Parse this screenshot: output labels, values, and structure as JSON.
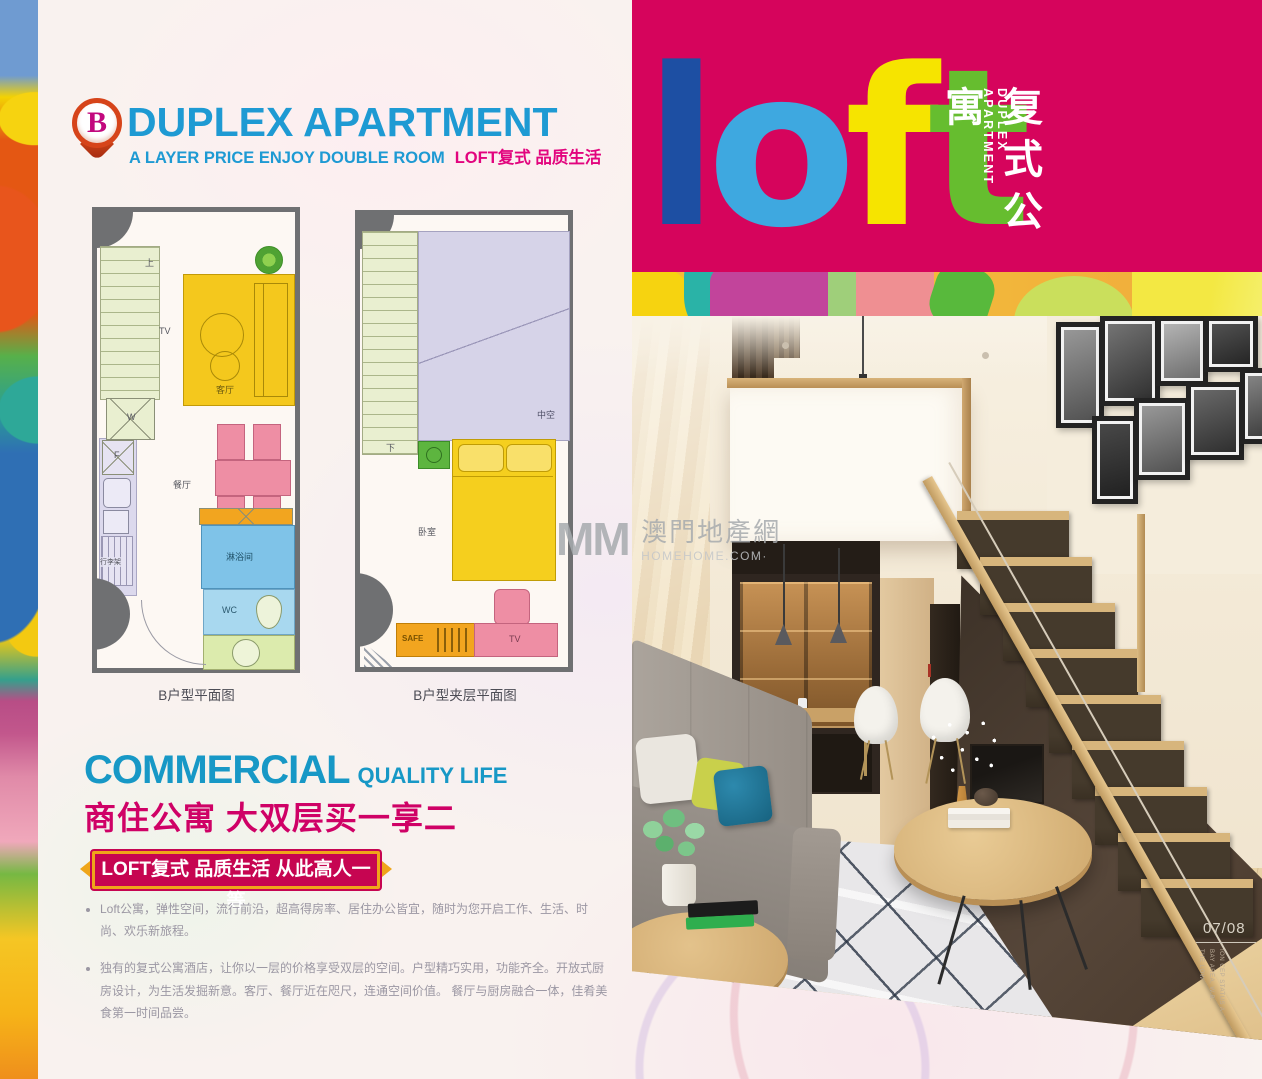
{
  "colors": {
    "brand_magenta": "#d6045c",
    "title_blue": "#1e9ad3",
    "heading_teal": "#1798c6",
    "headline_magenta": "#cf0166",
    "ribbon_bg": "#c60551",
    "ribbon_gold": "#efa51a",
    "loft_l": "#1d4fa3",
    "loft_o": "#3ea8e0",
    "loft_f": "#f6e400",
    "loft_t": "#66bd2f"
  },
  "header": {
    "badge_letter": "B",
    "title": "DUPLEX APARTMENT",
    "subtitle_en": "A LAYER PRICE ENJOY DOUBLE ROOM",
    "subtitle_cn": "LOFT复式 品质生活"
  },
  "floorplan1": {
    "caption": "B户型平面图",
    "labels": {
      "up": "上",
      "tv": "TV",
      "living": "客厅",
      "dining": "餐厅",
      "washer": "W",
      "fridge": "F",
      "luggage": "行李架",
      "shower": "淋浴间",
      "wc": "WC"
    }
  },
  "floorplan2": {
    "caption": "B户型夹层平面图",
    "labels": {
      "down": "下",
      "void": "中空",
      "bedroom": "卧室",
      "safe": "SAFE",
      "tv": "TV"
    }
  },
  "commercial": {
    "heading": "COMMERCIAL",
    "heading_sub": "QUALITY LIFE",
    "headline_cn": "商住公寓 大双层买一享二",
    "ribbon": "LOFT复式 品质生活 从此高人一等",
    "bullets": [
      "Loft公寓，弹性空间，流行前沿，超高得房率、居住办公皆宜，随时为您开启工作、生活、时尚、欢乐新旅程。",
      "独有的复式公寓酒店，让你以一层的价格享受双层的空间。户型精巧实用，功能齐全。开放式厨房设计，为生活发掘新意。客厅、餐厅近在咫尺，连通空间价值。 餐厅与厨房融合一体，佳肴美食第一时间品尝。"
    ]
  },
  "loft_banner": {
    "letters": [
      {
        "char": "l",
        "color": "#1d4fa3"
      },
      {
        "char": "o",
        "color": "#3ea8e0"
      },
      {
        "char": "f",
        "color": "#f6e400"
      },
      {
        "char": "t",
        "color": "#66bd2f"
      }
    ],
    "vertical_cn": "复式公寓",
    "vertical_en": "DUPLEX APARTMENT"
  },
  "watermark": {
    "mm": "MM",
    "site_cn": "澳門地產網",
    "site_en": "HOMEHOME.COM·"
  },
  "footer": {
    "page_no": "07/08",
    "fine_print": [
      "THE LOW",
      "BAY AREA, W.B.",
      "ION CEP STATUS A"
    ]
  }
}
